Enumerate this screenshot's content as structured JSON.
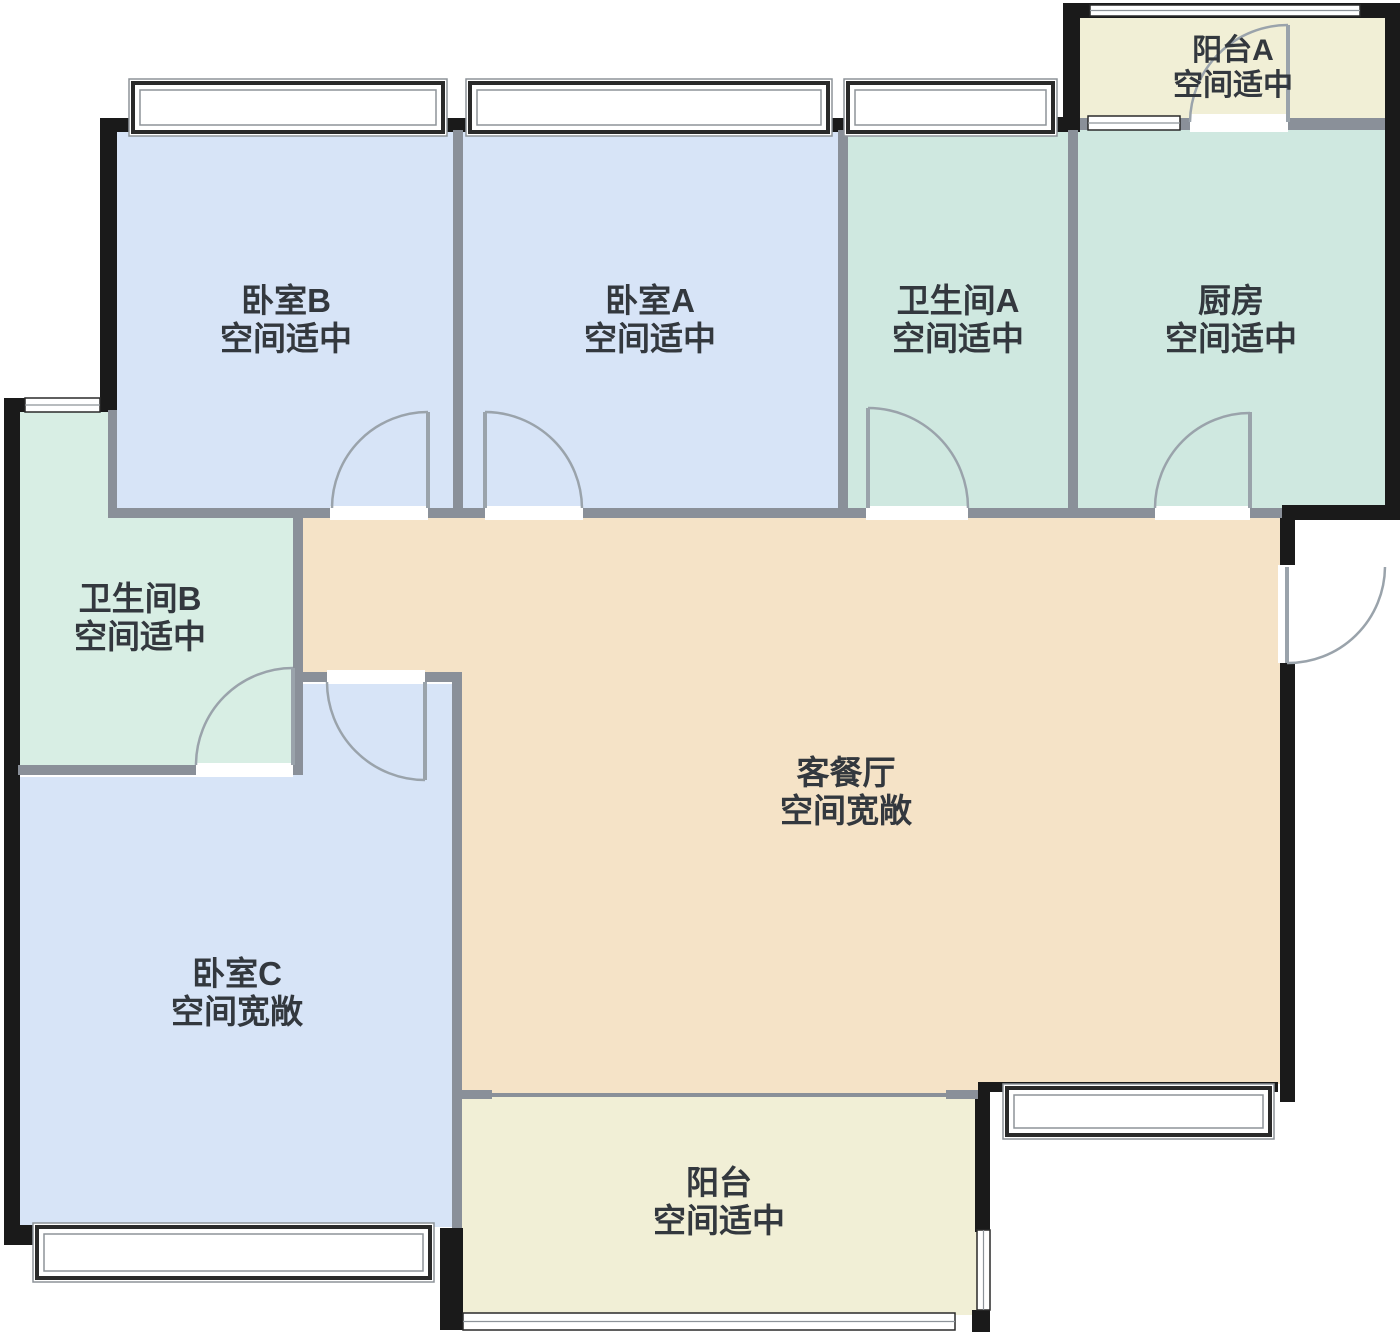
{
  "title": "户型图",
  "canvas": {
    "width": 1400,
    "height": 1335,
    "background": "#ffffff"
  },
  "palette": {
    "blue": "#d7e4f7",
    "teal": "#cfe8e0",
    "teal_b": "#d8eee4",
    "yellow": "#f1efd6",
    "beige": "#f5e3c7",
    "wall_ext": "#1a1a1a",
    "wall_int": "#8a9099",
    "door": "#9aa3ab",
    "window_frame": "#2a2a2a",
    "window_inner": "#8d9399",
    "label": "#33383e"
  },
  "rooms": [
    {
      "id": "bedroom-b",
      "name": "卧室B",
      "status": "空间适中",
      "color": "blue",
      "points": [
        [
          117,
          130
        ],
        [
          455,
          130
        ],
        [
          455,
          508
        ],
        [
          117,
          508
        ]
      ],
      "label": {
        "x": 286,
        "y1": 312,
        "y2": 350,
        "size": 33
      }
    },
    {
      "id": "bedroom-a",
      "name": "卧室A",
      "status": "空间适中",
      "color": "blue",
      "points": [
        [
          461,
          130
        ],
        [
          840,
          130
        ],
        [
          840,
          508
        ],
        [
          461,
          508
        ]
      ],
      "label": {
        "x": 650,
        "y1": 312,
        "y2": 350,
        "size": 33
      }
    },
    {
      "id": "bathroom-a",
      "name": "卫生间A",
      "status": "空间适中",
      "color": "teal",
      "points": [
        [
          846,
          130
        ],
        [
          1070,
          130
        ],
        [
          1070,
          508
        ],
        [
          846,
          508
        ]
      ],
      "label": {
        "x": 958,
        "y1": 312,
        "y2": 350,
        "size": 33
      }
    },
    {
      "id": "kitchen",
      "name": "厨房",
      "status": "空间适中",
      "color": "teal",
      "points": [
        [
          1076,
          120
        ],
        [
          1385,
          120
        ],
        [
          1385,
          508
        ],
        [
          1076,
          508
        ]
      ],
      "label": {
        "x": 1231,
        "y1": 312,
        "y2": 350,
        "size": 33
      }
    },
    {
      "id": "balcony-a",
      "name": "阳台A",
      "status": "空间适中",
      "color": "yellow",
      "points": [
        [
          1080,
          16
        ],
        [
          1385,
          16
        ],
        [
          1385,
          122
        ],
        [
          1080,
          122
        ]
      ],
      "label": {
        "x": 1233,
        "y1": 60,
        "y2": 95,
        "size": 30
      }
    },
    {
      "id": "bathroom-b",
      "name": "卫生间B",
      "status": "空间适中",
      "color": "teal_b",
      "points": [
        [
          18,
          412
        ],
        [
          110,
          412
        ],
        [
          110,
          517
        ],
        [
          293,
          517
        ],
        [
          293,
          767
        ],
        [
          18,
          767
        ]
      ],
      "label": {
        "x": 140,
        "y1": 610,
        "y2": 648,
        "size": 33
      }
    },
    {
      "id": "living-dining",
      "name": "客餐厅",
      "status": "空间宽敞",
      "color": "beige",
      "points": [
        [
          301,
          517
        ],
        [
          1284,
          517
        ],
        [
          1284,
          1084
        ],
        [
          978,
          1084
        ],
        [
          978,
          1096
        ],
        [
          460,
          1096
        ],
        [
          460,
          680
        ],
        [
          301,
          680
        ]
      ],
      "label": {
        "x": 846,
        "y1": 784,
        "y2": 822,
        "size": 33
      }
    },
    {
      "id": "bedroom-c",
      "name": "卧室C",
      "status": "空间宽敞",
      "color": "blue",
      "points": [
        [
          18,
          777
        ],
        [
          291,
          777
        ],
        [
          291,
          684
        ],
        [
          452,
          684
        ],
        [
          452,
          1227
        ],
        [
          18,
          1227
        ]
      ],
      "label": {
        "x": 237,
        "y1": 985,
        "y2": 1023,
        "size": 33
      }
    },
    {
      "id": "balcony",
      "name": "阳台",
      "status": "空间适中",
      "color": "yellow",
      "points": [
        [
          460,
          1096
        ],
        [
          978,
          1096
        ],
        [
          978,
          1315
        ],
        [
          460,
          1315
        ]
      ],
      "label": {
        "x": 719,
        "y1": 1194,
        "y2": 1232,
        "size": 33
      }
    }
  ],
  "walls_exterior": [
    [
      100,
      118,
      17,
      294
    ],
    [
      100,
      118,
      35,
      14
    ],
    [
      443,
      118,
      27,
      14
    ],
    [
      828,
      118,
      20,
      14
    ],
    [
      1053,
      117,
      27,
      15
    ],
    [
      1063,
      3,
      17,
      117
    ],
    [
      1063,
      3,
      337,
      15
    ],
    [
      1385,
      3,
      15,
      517
    ],
    [
      1282,
      505,
      118,
      15
    ],
    [
      1280,
      513,
      15,
      54
    ],
    [
      1280,
      663,
      15,
      439
    ],
    [
      978,
      1082,
      300,
      10
    ],
    [
      975,
      1092,
      15,
      140
    ],
    [
      972,
      1310,
      18,
      22
    ],
    [
      440,
      1228,
      23,
      102
    ],
    [
      5,
      398,
      112,
      14
    ],
    [
      4,
      398,
      16,
      847
    ],
    [
      4,
      1225,
      30,
      20
    ]
  ],
  "walls_interior": [
    [
      453,
      130,
      10,
      378
    ],
    [
      838,
      130,
      10,
      378
    ],
    [
      1068,
      130,
      10,
      378
    ],
    [
      108,
      508,
      222,
      10
    ],
    [
      428,
      508,
      57,
      10
    ],
    [
      583,
      508,
      285,
      10
    ],
    [
      968,
      508,
      187,
      10
    ],
    [
      1250,
      508,
      32,
      10
    ],
    [
      108,
      410,
      9,
      107
    ],
    [
      293,
      517,
      10,
      250
    ],
    [
      18,
      765,
      178,
      10
    ],
    [
      291,
      765,
      12,
      10
    ],
    [
      293,
      672,
      34,
      10
    ],
    [
      425,
      672,
      37,
      10
    ],
    [
      452,
      672,
      10,
      556
    ],
    [
      1080,
      118,
      8,
      12
    ],
    [
      1180,
      118,
      10,
      12
    ],
    [
      1288,
      118,
      97,
      12
    ],
    [
      460,
      1090,
      32,
      9
    ],
    [
      946,
      1090,
      32,
      9
    ],
    [
      460,
      1093,
      518,
      4
    ]
  ],
  "windows": [
    {
      "x": 133,
      "y": 83,
      "w": 310,
      "h": 49,
      "style": "box",
      "name": "bedroom-b-top-window"
    },
    {
      "x": 470,
      "y": 83,
      "w": 358,
      "h": 49,
      "style": "box",
      "name": "bedroom-a-top-window"
    },
    {
      "x": 848,
      "y": 83,
      "w": 205,
      "h": 49,
      "style": "box",
      "name": "bathroom-a-top-window"
    },
    {
      "x": 37,
      "y": 1227,
      "w": 393,
      "h": 51,
      "style": "box",
      "name": "bedroom-c-bottom-window"
    },
    {
      "x": 1007,
      "y": 1088,
      "w": 263,
      "h": 47,
      "style": "box",
      "name": "living-south-window"
    },
    {
      "x": 1090,
      "y": 5,
      "w": 270,
      "h": 11,
      "style": "lines-h",
      "name": "balcony-a-top-window"
    },
    {
      "x": 1088,
      "y": 116,
      "w": 92,
      "h": 14,
      "style": "lines-h",
      "name": "kitchen-balcony-window"
    },
    {
      "x": 25,
      "y": 398,
      "w": 75,
      "h": 14,
      "style": "lines-h",
      "name": "bathroom-b-window"
    },
    {
      "x": 463,
      "y": 1313,
      "w": 492,
      "h": 17,
      "style": "lines-h",
      "name": "balcony-bottom-window"
    },
    {
      "x": 977,
      "y": 1230,
      "w": 13,
      "h": 80,
      "style": "lines-v",
      "name": "balcony-right-window"
    }
  ],
  "doors": [
    {
      "name": "bedroom-b-door",
      "gap": [
        330,
        506,
        98,
        14
      ],
      "leaf": [
        428,
        412,
        428,
        508
      ],
      "arc": "M332 508 A96 96 0 0 1 428 412"
    },
    {
      "name": "bedroom-a-door",
      "gap": [
        485,
        506,
        98,
        14
      ],
      "leaf": [
        485,
        412,
        485,
        508
      ],
      "arc": "M485 412 A97 97 0 0 1 582 508"
    },
    {
      "name": "bathroom-a-door",
      "gap": [
        866,
        506,
        102,
        14
      ],
      "leaf": [
        868,
        408,
        868,
        508
      ],
      "arc": "M868 408 A100 100 0 0 1 968 508"
    },
    {
      "name": "kitchen-door",
      "gap": [
        1155,
        506,
        95,
        14
      ],
      "leaf": [
        1250,
        412,
        1250,
        508
      ],
      "arc": "M1155 508 A95 95 0 0 1 1250 413"
    },
    {
      "name": "bathroom-b-door",
      "gap": [
        196,
        763,
        97,
        14
      ],
      "leaf": [
        293,
        668,
        293,
        765
      ],
      "arc": "M196 765 A97 97 0 0 1 293 668"
    },
    {
      "name": "bedroom-c-door",
      "gap": [
        327,
        670,
        98,
        14
      ],
      "leaf": [
        425,
        682,
        425,
        780
      ],
      "arc": "M327 682 A98 98 0 0 0 425 780"
    },
    {
      "name": "balcony-a-door",
      "gap": [
        1190,
        114,
        98,
        18
      ],
      "leaf": [
        1288,
        25,
        1288,
        122
      ],
      "arc": "M1190 122 A98 98 0 0 1 1288 25"
    },
    {
      "name": "entry-door",
      "gap": [
        1278,
        565,
        20,
        98
      ],
      "leaf": [
        1287,
        567,
        1287,
        663
      ],
      "arc": "M1287 663 A97 97 0 0 0 1385 567"
    }
  ]
}
